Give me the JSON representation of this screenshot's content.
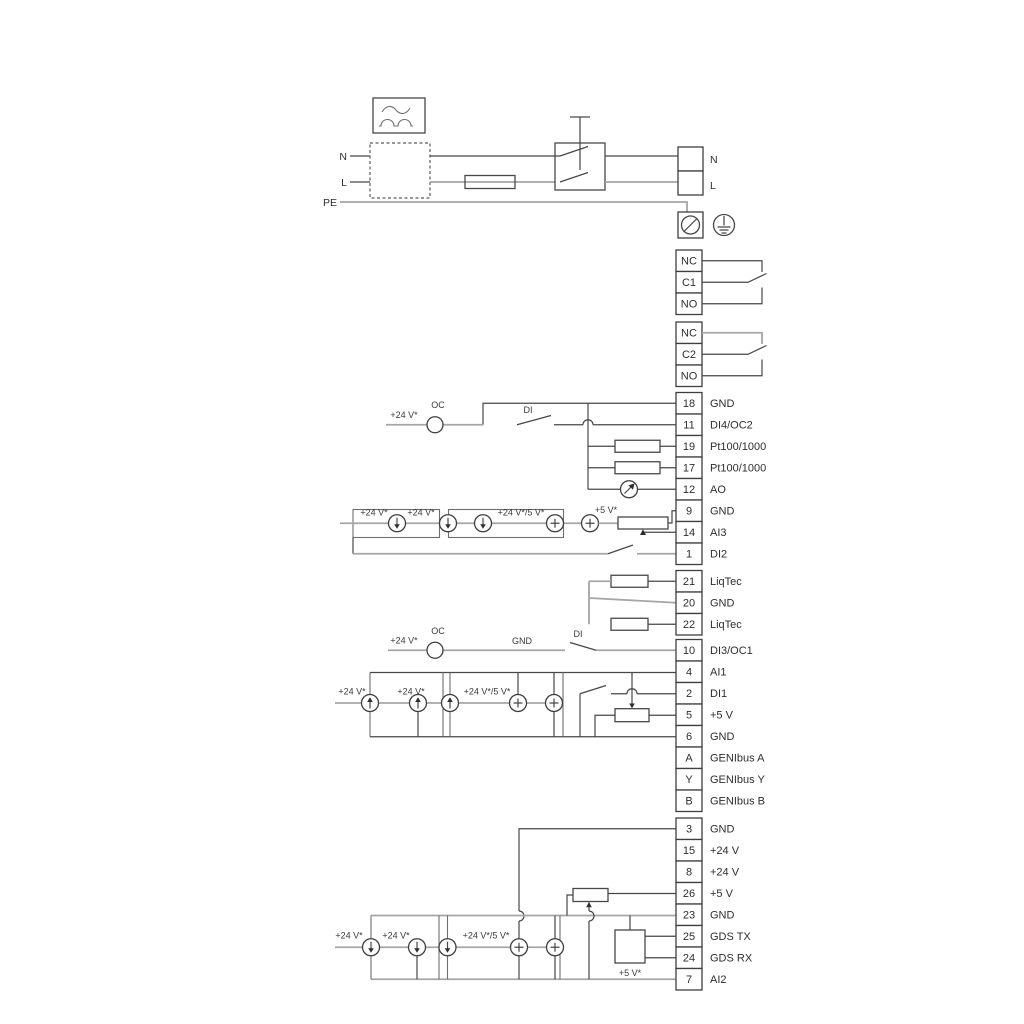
{
  "power": {
    "n_left": "N",
    "l_left": "L",
    "pe": "PE",
    "n_right": "N",
    "l_right": "L"
  },
  "relay1": {
    "t1": "NC",
    "t2": "C1",
    "t3": "NO"
  },
  "relay2": {
    "t1": "NC",
    "t2": "C2",
    "t3": "NO"
  },
  "groupA": [
    {
      "num": "18",
      "label": "GND"
    },
    {
      "num": "11",
      "label": "DI4/OC2"
    },
    {
      "num": "19",
      "label": "Pt100/1000"
    },
    {
      "num": "17",
      "label": "Pt100/1000"
    },
    {
      "num": "12",
      "label": "AO"
    },
    {
      "num": "9",
      "label": "GND"
    },
    {
      "num": "14",
      "label": "AI3"
    },
    {
      "num": "1",
      "label": "DI2"
    }
  ],
  "groupB": [
    {
      "num": "21",
      "label": "LiqTec"
    },
    {
      "num": "20",
      "label": "GND"
    },
    {
      "num": "22",
      "label": "LiqTec"
    }
  ],
  "groupC": [
    {
      "num": "10",
      "label": "DI3/OC1"
    },
    {
      "num": "4",
      "label": "AI1"
    },
    {
      "num": "2",
      "label": "DI1"
    },
    {
      "num": "5",
      "label": "+5 V"
    },
    {
      "num": "6",
      "label": "GND"
    },
    {
      "num": "A",
      "label": "GENIbus A"
    },
    {
      "num": "Y",
      "label": "GENIbus Y"
    },
    {
      "num": "B",
      "label": "GENIbus B"
    }
  ],
  "groupD": [
    {
      "num": "3",
      "label": "GND"
    },
    {
      "num": "15",
      "label": "+24 V"
    },
    {
      "num": "8",
      "label": "+24 V"
    },
    {
      "num": "26",
      "label": "+5 V"
    },
    {
      "num": "23",
      "label": "GND"
    },
    {
      "num": "25",
      "label": "GDS TX"
    },
    {
      "num": "24",
      "label": "GDS RX"
    },
    {
      "num": "7",
      "label": "AI2"
    }
  ],
  "ann": {
    "v24": "+24 V*",
    "v24_5": "+24 V*/5 V*",
    "v5": "+5 V*",
    "oc": "OC",
    "di": "DI",
    "gnd": "GND"
  },
  "colors": {
    "wire_gray": "#a6a6a6",
    "wire_dark": "#474747",
    "text": "#2e2e2e",
    "background": "#ffffff"
  }
}
